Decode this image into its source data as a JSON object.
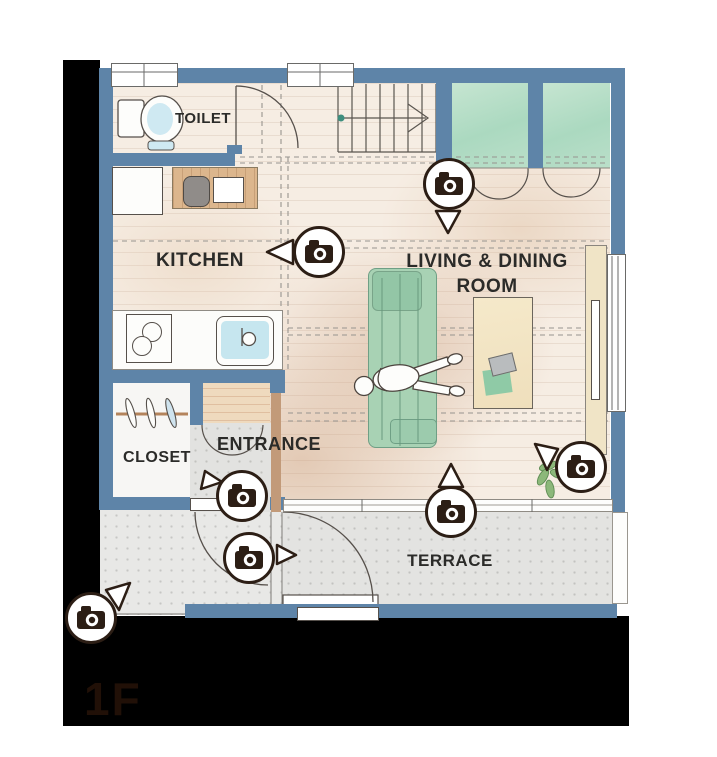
{
  "plan": {
    "floor_label": "1F",
    "labels": {
      "toilet": "TOILET",
      "kitchen": "KITCHEN",
      "living_line1": "LIVING & DINING",
      "living_line2": "ROOM",
      "entrance": "ENTRANCE",
      "closet": "CLOSET",
      "terrace": "TERRACE"
    },
    "cameras": [
      {
        "id": "hall-view",
        "area": "hallway-living-boundary",
        "pointer": "down",
        "icon": "camera-icon"
      },
      {
        "id": "kitchen-view",
        "area": "kitchen",
        "pointer": "left",
        "icon": "camera-icon"
      },
      {
        "id": "living-east-view",
        "area": "living-dining-east",
        "pointer": "up-left",
        "icon": "camera-icon"
      },
      {
        "id": "living-south-view",
        "area": "living-dining-south",
        "pointer": "up",
        "icon": "camera-icon"
      },
      {
        "id": "entrance-inner-view",
        "area": "entrance",
        "pointer": "down-left",
        "icon": "camera-icon"
      },
      {
        "id": "entrance-outer-view",
        "area": "entrance-porch",
        "pointer": "right",
        "icon": "camera-icon"
      },
      {
        "id": "approach-view",
        "area": "approach-outside",
        "pointer": "up-right",
        "icon": "camera-icon"
      }
    ]
  },
  "colors": {
    "wall_blue": "#5E84A8",
    "room_green": "#B9DFC9",
    "floor_cream": "#F6EDE3",
    "terrace_gray": "#E3E3E1",
    "entrance_wood": "#EFDABE",
    "water_blue": "#C6E6EF",
    "marker_dark": "#2C1E15",
    "matte_black": "#000000"
  }
}
